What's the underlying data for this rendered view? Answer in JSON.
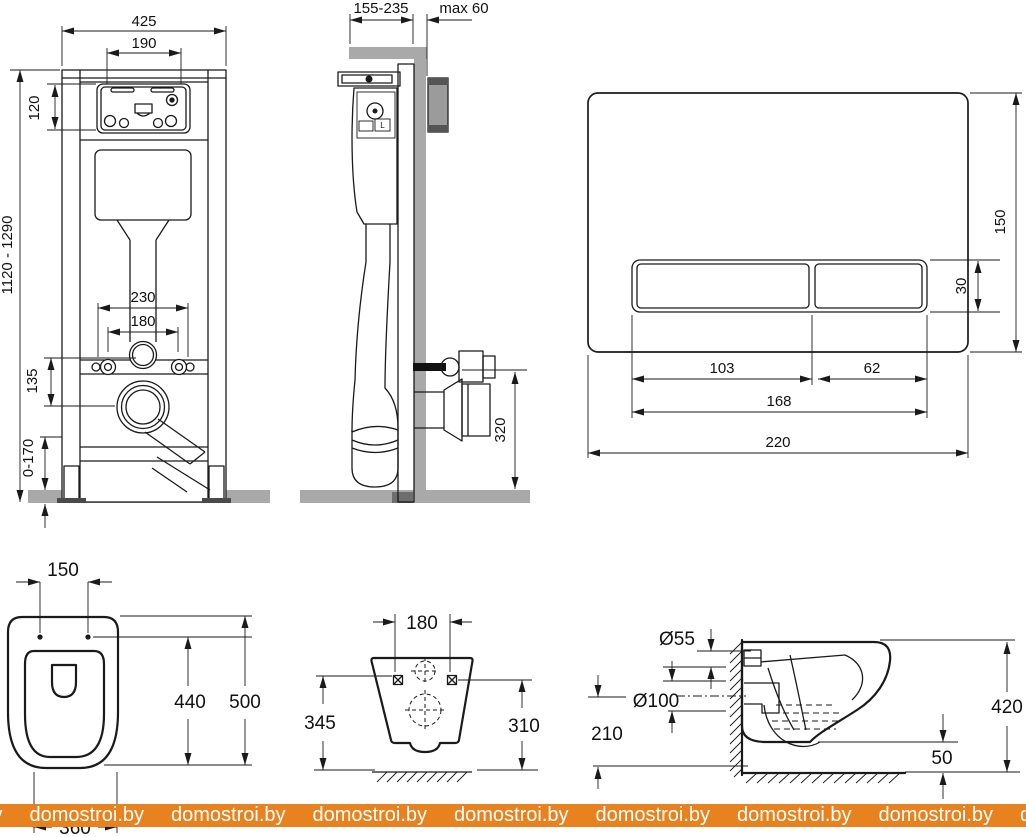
{
  "watermark": {
    "text": "domostroi.by",
    "repeat": 9
  },
  "colors": {
    "line": "#1a1a1a",
    "wall_gray": "#a9a9a9",
    "watermark_band": "#e8821f",
    "watermark_text": "#ffffff"
  },
  "views": {
    "frame_front": {
      "dims": {
        "width_total": "425",
        "opening_width": "190",
        "panel_height": "120",
        "frame_height_range": "1120 - 1290",
        "fixing_spacing_outer": "230",
        "fixing_spacing_inner": "180",
        "inlet_to_outlet": "135",
        "leg_adjust_range": "0-170"
      }
    },
    "frame_side": {
      "dims": {
        "depth_range": "155-235",
        "wall_thickness_max": "max 60",
        "outlet_height": "320"
      },
      "labels": {
        "valve_mark": "L"
      }
    },
    "flush_plate": {
      "dims": {
        "plate_height": "150",
        "button_height": "30",
        "button_large_width": "103",
        "button_small_width": "62",
        "buttons_total_width": "168",
        "plate_width": "220"
      }
    },
    "bowl_top": {
      "dims": {
        "hinge_hole_spacing": "150",
        "depth_to_holes": "440",
        "total_depth": "500",
        "bowl_width": "360"
      }
    },
    "bowl_back": {
      "dims": {
        "fixing_hole_spacing": "180",
        "height_left": "345",
        "height_right": "310"
      }
    },
    "bowl_side": {
      "dims": {
        "inlet_diameter": "Ø55",
        "outlet_diameter": "Ø100",
        "outlet_center_height": "210",
        "bowl_height": "420",
        "bottom_clearance": "50"
      }
    }
  }
}
